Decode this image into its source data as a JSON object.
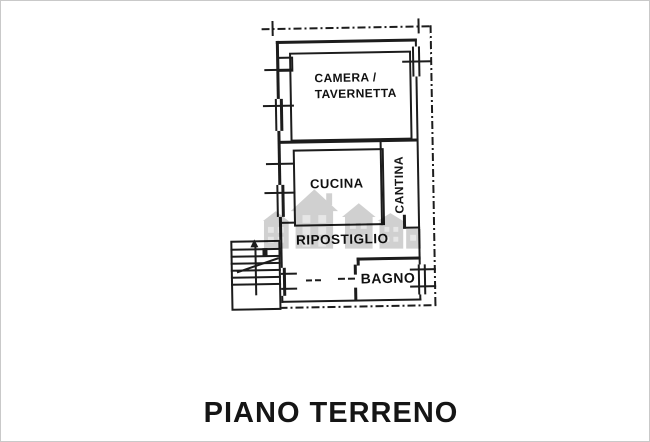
{
  "page": {
    "title": "PIANO TERRENO"
  },
  "plan": {
    "rooms": {
      "camera_tavernetta": "CAMERA /\nTAVERNETTA",
      "cucina": "CUCINA",
      "cantina": "CANTINA",
      "ripostiglio": "RIPOSTIGLIO",
      "bagno": "BAGNO"
    },
    "watermark_icon": "buildings-skyline-logo",
    "colors": {
      "wall": "#1c1c1c",
      "watermark": "#9a9a9a",
      "background": "#ffffff"
    }
  }
}
